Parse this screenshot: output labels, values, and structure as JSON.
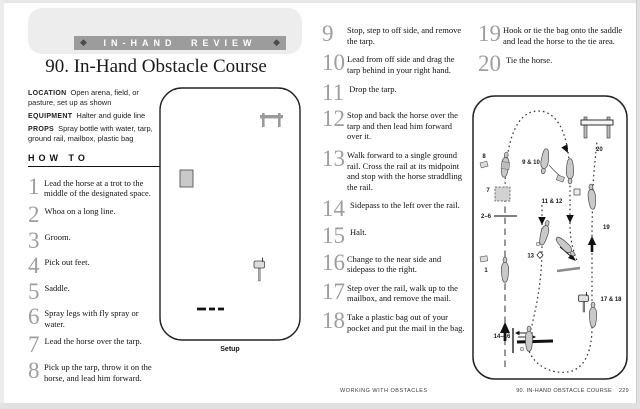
{
  "banner": {
    "label": "IN-HAND REVIEW"
  },
  "title": "90. In-Hand Obstacle Course",
  "info": [
    {
      "label": "LOCATION",
      "text": "Open arena, field, or pasture, set up as shown"
    },
    {
      "label": "EQUIPMENT",
      "text": "Halter and guide line"
    },
    {
      "label": "PROPS",
      "text": "Spray bottle with water, tarp, ground rail, mailbox, plastic bag"
    }
  ],
  "how_to_label": "HOW TO",
  "steps_left": [
    {
      "num": "1",
      "text": "Lead the horse at a trot to the middle of the designated space."
    },
    {
      "num": "2",
      "text": "Whoa on a long line."
    },
    {
      "num": "3",
      "text": "Groom."
    },
    {
      "num": "4",
      "text": "Pick out feet."
    },
    {
      "num": "5",
      "text": "Saddle."
    },
    {
      "num": "6",
      "text": "Spray legs with fly spray or water."
    },
    {
      "num": "7",
      "text": "Lead the horse over the tarp."
    },
    {
      "num": "8",
      "text": "Pick up the tarp, throw it on the horse, and lead him forward."
    }
  ],
  "steps_middle": [
    {
      "num": "9",
      "text": "Stop, step to off side, and remove the tarp."
    },
    {
      "num": "10",
      "text": "Lead from off side and drag the tarp behind in your right hand."
    },
    {
      "num": "11",
      "text": "Drop the tarp."
    },
    {
      "num": "12",
      "text": "Stop and back the horse over the tarp and then lead him forward over it."
    },
    {
      "num": "13",
      "text": "Walk forward to a single ground rail. Cross the rail at its midpoint and stop with the horse straddling the rail."
    },
    {
      "num": "14",
      "text": "Sidepass to the left over the rail."
    },
    {
      "num": "15",
      "text": "Halt."
    },
    {
      "num": "16",
      "text": "Change to the near side and sidepass to the right."
    },
    {
      "num": "17",
      "text": "Step over the rail, walk up to the mailbox, and remove the mail."
    },
    {
      "num": "18",
      "text": "Take a plastic bag out of your pocket and put the mail in the bag."
    }
  ],
  "steps_right": [
    {
      "num": "19",
      "text": "Hook or tie the bag onto the saddle and lead the horse to the tie area."
    },
    {
      "num": "20",
      "text": "Tie the horse."
    }
  ],
  "setup_diagram": {
    "caption": "Setup"
  },
  "course_diagram": {
    "labels": {
      "s1": "1",
      "s2_6": "2–6",
      "s7": "7",
      "s8": "8",
      "s9_10": "9 & 10",
      "s11_12": "11 & 12",
      "s13": "13",
      "s14_16": "14–16",
      "s17_18": "17 & 18",
      "s19": "19",
      "s20": "20"
    }
  },
  "footer": {
    "section": "WORKING WITH OBSTACLES",
    "chapter": "90. IN-HAND OBSTACLE COURSE",
    "page": "229"
  }
}
